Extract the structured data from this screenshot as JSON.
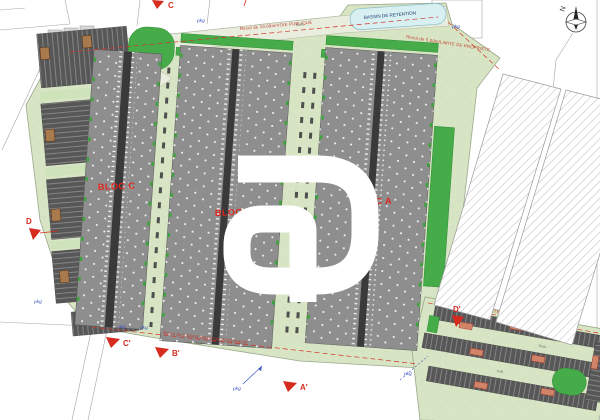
{
  "plan": {
    "blocs": [
      {
        "label": "BLOC C"
      },
      {
        "label": "BLOC B"
      },
      {
        "label": "BLOC A"
      }
    ],
    "annotations": {
      "bassin": "BASSIN DE RETENTION",
      "recul_voie": "Recul de 10.00m/VOIE PUBLIQUE",
      "recul_limite": "Recul de 5.00m/LIMITE DE PROPRIETE",
      "pkg": "pkg"
    },
    "section_markers": [
      {
        "label": "C"
      },
      {
        "label": "D"
      },
      {
        "label": "C'"
      },
      {
        "label": "B'"
      },
      {
        "label": "A'"
      },
      {
        "label": "D'"
      }
    ],
    "compass": {
      "label": "N"
    },
    "dimensions": {
      "d1": "5.00",
      "d2": "10.00",
      "d3": "75.00"
    },
    "colors": {
      "site_green": "#d8e5c4",
      "road": "#e9eddd",
      "building_gray": "#8e8e8e",
      "bright_green": "#46ab49",
      "parking_dark": "#575757",
      "annotation_red": "#d63327",
      "annotation_blue": "#3c55c0",
      "pond_cyan": "#d9f0f2",
      "watermark": "#ffffff"
    }
  }
}
